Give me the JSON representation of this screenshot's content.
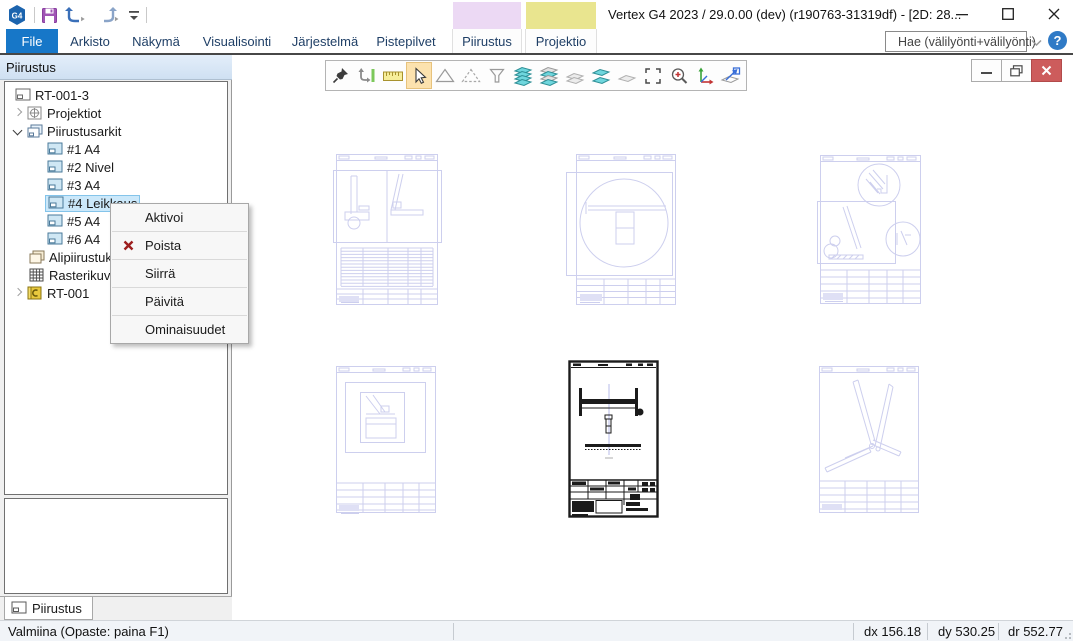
{
  "titlebar": {
    "title": "Vertex G4 2023 / 29.0.00 (dev) (r190763-31319df) - [2D: 28...",
    "logo_text": "G4"
  },
  "quick_access": {
    "icons": [
      "save",
      "undo",
      "redo",
      "customize-quick-access"
    ]
  },
  "ribbon": {
    "tabs": [
      {
        "label": "File",
        "active": true
      },
      {
        "label": "Arkisto"
      },
      {
        "label": "Näkymä"
      },
      {
        "label": "Visualisointi"
      },
      {
        "label": "Järjestelmä"
      },
      {
        "label": "Pistepilvet"
      },
      {
        "label": "Piirustus",
        "contextual": true
      },
      {
        "label": "Projektio",
        "contextual": true
      }
    ],
    "search": {
      "placeholder": "Hae (välilyönti+välilyönti)"
    },
    "help_glyph": "?",
    "colors": {
      "file_tab": "#1777c8",
      "contextual_piirustus": "#ecd9f4",
      "contextual_projektio": "#e9e58f"
    }
  },
  "toolbar": {
    "active_index": 3,
    "icons": [
      "pushpin",
      "drag-bounds",
      "ruler",
      "select-cursor",
      "polygon",
      "polygon-dashed",
      "filter-funnel",
      "layers-all",
      "layers-used",
      "layers-off",
      "layers-pair",
      "layer-single",
      "select-area",
      "zoom-area",
      "axes",
      "fit-view"
    ]
  },
  "sidebar": {
    "header": "Piirustus",
    "tree": [
      {
        "label": "RT-001-3",
        "depth": 0,
        "icon": "drawing-sheet"
      },
      {
        "label": "Projektiot",
        "depth": 1,
        "icon": "projection",
        "expander": "collapsed"
      },
      {
        "label": "Piirustusarkit",
        "depth": 1,
        "icon": "sheets-blue",
        "expander": "expanded"
      },
      {
        "label": "#1 A4",
        "depth": 2,
        "icon": "sheet-blue"
      },
      {
        "label": "#2 Nivel",
        "depth": 2,
        "icon": "sheet-blue"
      },
      {
        "label": "#3 A4",
        "depth": 2,
        "icon": "sheet-blue"
      },
      {
        "label": "#4 Leikkaus",
        "depth": 2,
        "icon": "sheet-blue",
        "selected": true
      },
      {
        "label": "#5 A4",
        "depth": 2,
        "icon": "sheet-blue"
      },
      {
        "label": "#6 A4",
        "depth": 2,
        "icon": "sheet-blue"
      },
      {
        "label": "Alipiirustuk",
        "depth": 1,
        "icon": "sheets-beige"
      },
      {
        "label": "Rasterikuva",
        "depth": 1,
        "icon": "raster-grid"
      },
      {
        "label": "RT-001",
        "depth": 1,
        "icon": "model-yellow",
        "expander": "collapsed"
      }
    ],
    "bottom_tab": {
      "label": "Piirustus"
    }
  },
  "context_menu": {
    "items": [
      {
        "label": "Aktivoi"
      },
      {
        "label": "Poista",
        "icon": "delete-x"
      },
      {
        "label": "Siirrä"
      },
      {
        "label": "Päivitä"
      },
      {
        "label": "Ominaisuudet"
      }
    ]
  },
  "statusbar": {
    "ready": "Valmiina (Opaste: paina F1)",
    "dx": {
      "label": "dx",
      "value": "156.18"
    },
    "dy": {
      "label": "dy",
      "value": "530.25"
    },
    "dr": {
      "label": "dr",
      "value": "552.77"
    }
  }
}
